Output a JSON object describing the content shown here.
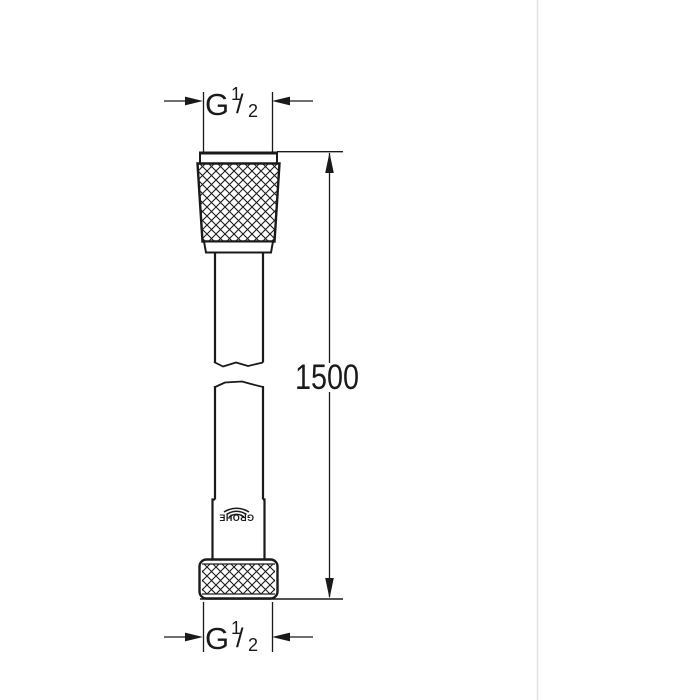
{
  "page": {
    "background": "#ffffff",
    "line_color": "#1a1a1a",
    "divider_color": "#e3e3e3"
  },
  "dimensions": {
    "top_thread": {
      "g": "G",
      "numerator": "1",
      "slash": "/",
      "denominator": "2"
    },
    "bottom_thread": {
      "g": "G",
      "numerator": "1",
      "slash": "/",
      "denominator": "2"
    },
    "length": {
      "value": "1500"
    }
  },
  "product": {
    "brand": "GROHE"
  }
}
